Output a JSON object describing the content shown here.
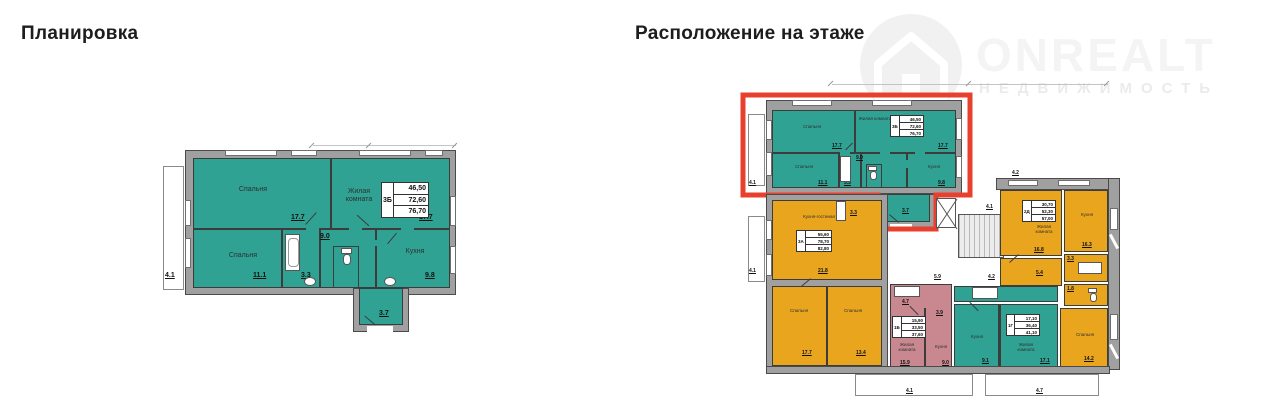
{
  "headings": {
    "left": "Планировка",
    "right": "Расположение на этаже"
  },
  "logo": {
    "brand": "ONREALT",
    "sub": "НЕДВИЖИМОСТЬ"
  },
  "unit": {
    "type": "3Б",
    "a1": "46,50",
    "a2": "72,60",
    "a3": "76,70"
  },
  "lp": {
    "bedroom1": "Спальня",
    "bedroom1_area": "17.7",
    "living": "Жилая комната",
    "living_area": "17.7",
    "bedroom2": "Спальня",
    "bedroom2_area": "11.1",
    "kitchen": "Кухня",
    "kitchen_area": "9.8",
    "hall_area": "9.0",
    "bath_area": "3.3",
    "entry_area": "3.7",
    "balcony_area": "4.1"
  },
  "fp": {
    "a3b": {
      "type": "3Б",
      "a1": "46,50",
      "a2": "72,60",
      "a3": "76,70",
      "bedroom1": "Спальня",
      "bedroom1_area": "17.7",
      "living": "Жилая комната",
      "living_area": "17.7",
      "bedroom2": "Спальня",
      "bedroom2_area": "11.1",
      "kitchen": "Кухня",
      "kitchen_area": "9.8",
      "hall_area": "9.0",
      "bath_area": "3.3",
      "entry_area": "3.7",
      "balcony_area": "4.1"
    },
    "a3a": {
      "type": "3А",
      "a1": "55,60",
      "a2": "78,70",
      "a3": "82,80",
      "kitchen_living": "Кухня-гостиная",
      "kitchen_living_area": "21.8",
      "bedroom1": "Спальня",
      "bedroom1_area": "17.7",
      "bedroom2": "Спальня",
      "bedroom2_area": "13.4",
      "bath_area": "3.3",
      "balcony_area": "4.1"
    },
    "a1b": {
      "type": "1Б",
      "a1": "15,90",
      "a2": "33,50",
      "a3": "37,60",
      "living": "Жилая комната",
      "living_area": "15.9",
      "kitchen": "Кухня",
      "kitchen_area": "9.0",
      "hall_area": "4.7",
      "bath_area": "3.9"
    },
    "a2d": {
      "type": "2Д",
      "a1": "30,70",
      "a2": "52,30",
      "a3": "57,00",
      "living": "Жилая комната",
      "living_area": "16.8",
      "kitchen": "Кухня",
      "kitchen_area": "16.3",
      "bedroom": "Спальня",
      "bedroom_area": "14.2",
      "hall_area": "5.4",
      "bath_area": "3.3",
      "wc_area": "1.8",
      "top_area": "4.2"
    },
    "a1g": {
      "type": "1Г",
      "a1": "17,10",
      "a2": "36,40",
      "a3": "41,10",
      "kitchen": "Кухня",
      "kitchen_area": "9.1",
      "living": "Жилая комната",
      "living_area": "17.1"
    },
    "common": {
      "stairs_hall": "4.1",
      "hall1": "5.9",
      "hall2": "4.2",
      "hall3": "3.3",
      "balcony1": "4.1",
      "balcony2": "4.7"
    }
  },
  "colors": {
    "teal": "#2fa294",
    "orange": "#e9a51d",
    "pink": "#c9878f",
    "highlight_red": "#e8402f",
    "wall_gray": "#a0a0a0"
  }
}
